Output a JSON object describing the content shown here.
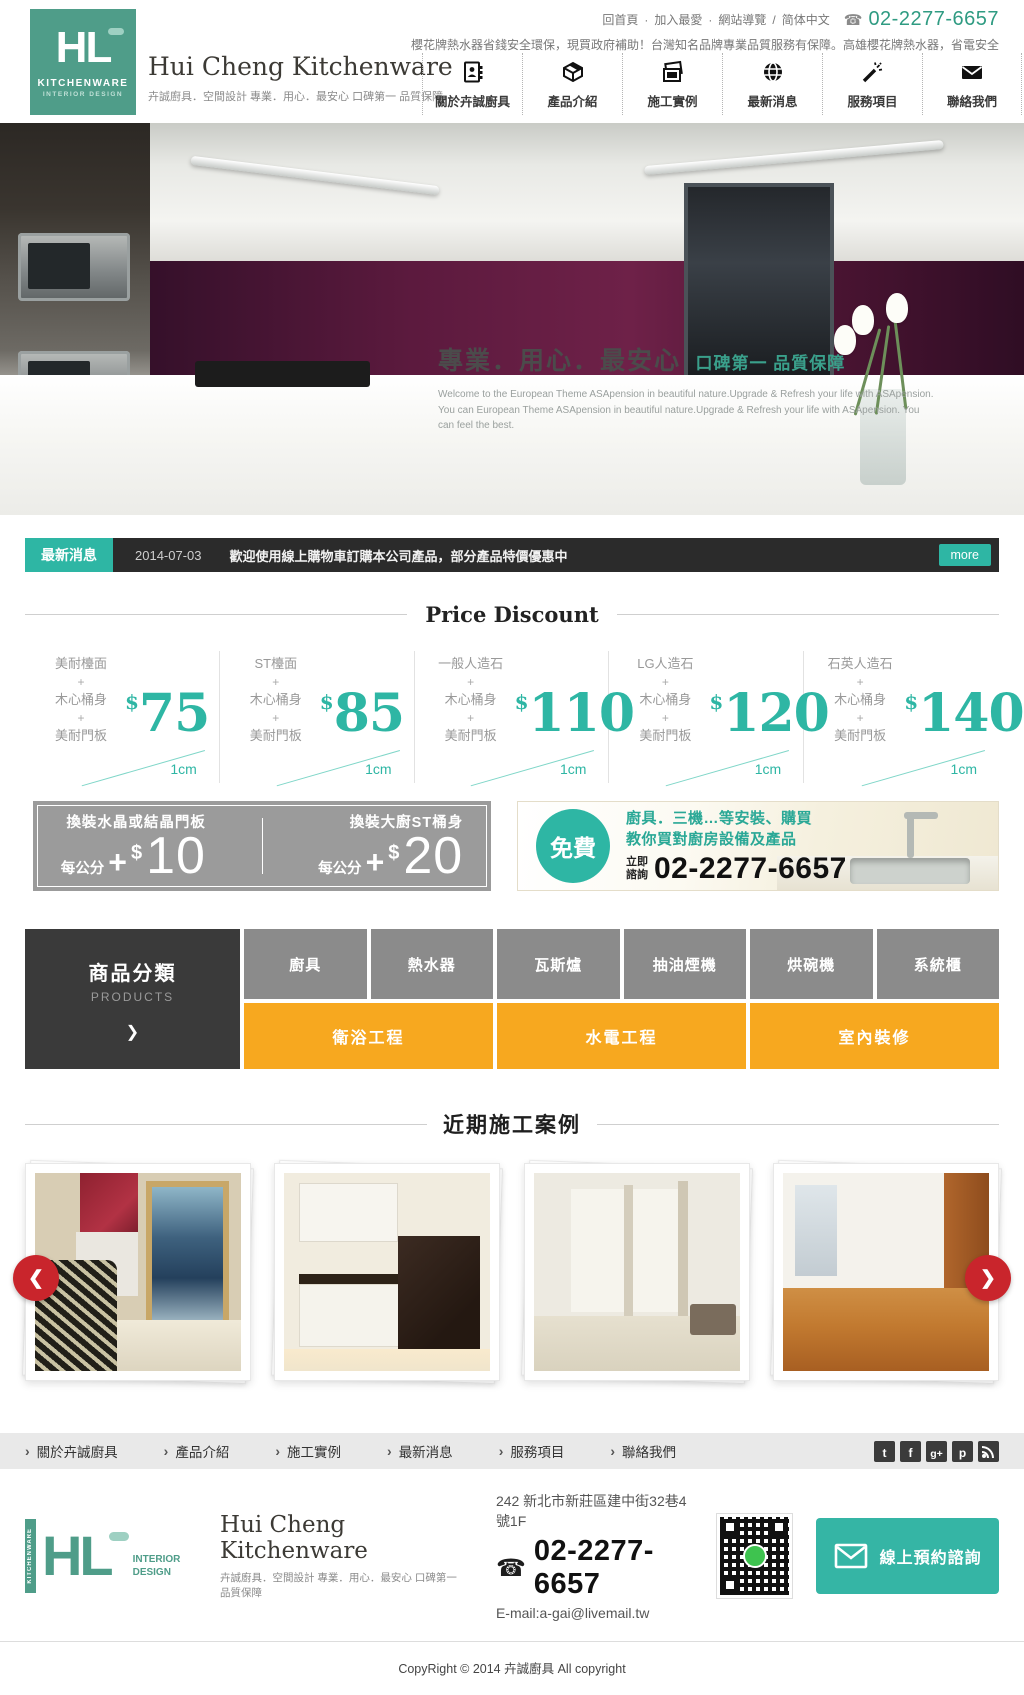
{
  "colors": {
    "brand_green": "#4f9d89",
    "accent_teal": "#2eb6a4",
    "orange": "#f7a81f",
    "dark_bar": "#2b2b2b",
    "gray_block": "#8b8b8b",
    "red_arrow": "#c9252c"
  },
  "topbar": {
    "links": [
      {
        "label": "回首頁"
      },
      {
        "label": "加入最愛"
      },
      {
        "label": "網站導覽"
      },
      {
        "label": "简体中文"
      }
    ],
    "sep": "·",
    "slash": "/",
    "phone_icon": "☎",
    "phone": "02-2277-6657",
    "marquee": "櫻花牌熱水器省錢安全環保，現買政府補助！台灣知名品牌專業品質服務有保障。高雄櫻花牌熱水器，省電安全"
  },
  "brand": {
    "monogram": "HL",
    "kitchenware": "KITCHENWARE",
    "interior": "INTERIOR DESIGN",
    "name": "Hui Cheng Kitchenware",
    "tagline": "卉誠廚具．空間設計 專業．用心．最安心 口碑第一 品質保障"
  },
  "nav": {
    "items": [
      {
        "label": "關於卉誠廚具",
        "icon": "address-book-icon"
      },
      {
        "label": "產品介紹",
        "icon": "product-box-icon"
      },
      {
        "label": "施工實例",
        "icon": "photos-icon"
      },
      {
        "label": "最新消息",
        "icon": "globe-icon"
      },
      {
        "label": "服務項目",
        "icon": "magic-wand-icon"
      },
      {
        "label": "聯絡我們",
        "icon": "envelope-icon"
      }
    ]
  },
  "hero": {
    "title": "專業．用心．最安心",
    "subtitle": "口碑第一 品質保障",
    "body": "Welcome to the European Theme ASApension in beautiful nature.Upgrade & Refresh your life with ASApension. You can European Theme ASApension in beautiful nature.Upgrade & Refresh your life with ASApension. You can feel the best."
  },
  "news": {
    "label": "最新消息",
    "date": "2014-07-03",
    "text": "歡迎使用線上購物車訂購本公司產品，部分產品特價優惠中",
    "more_label": "more"
  },
  "price": {
    "title": "Price Discount",
    "plus": "+",
    "currency": "$",
    "unit": "1cm",
    "cards": [
      {
        "top": "美耐檯面",
        "mid": "木心桶身",
        "bottom": "美耐門板",
        "value": "75"
      },
      {
        "top": "ST檯面",
        "mid": "木心桶身",
        "bottom": "美耐門板",
        "value": "85"
      },
      {
        "top": "一般人造石",
        "mid": "木心桶身",
        "bottom": "美耐門板",
        "value": "110"
      },
      {
        "top": "LG人造石",
        "mid": "木心桶身",
        "bottom": "美耐門板",
        "value": "120"
      },
      {
        "top": "石英人造石",
        "mid": "木心桶身",
        "bottom": "美耐門板",
        "value": "140"
      }
    ]
  },
  "addons": {
    "plus": "+",
    "currency": "$",
    "items": [
      {
        "label": "換裝水晶或結晶門板",
        "per": "每公分",
        "value": "10"
      },
      {
        "label": "換裝大廚ST桶身",
        "per": "每公分",
        "value": "20"
      }
    ]
  },
  "consult": {
    "badge": "免費",
    "line1": "廚具．三機…等安裝、購買",
    "line2": "教你買對廚房設備及產品",
    "cta1": "立即",
    "cta2": "諮詢",
    "phone": "02-2277-6657"
  },
  "products": {
    "title": "商品分類",
    "subtitle": "PRODUCTS",
    "arrow": "❯",
    "items": [
      "廚具",
      "熱水器",
      "瓦斯爐",
      "抽油煙機",
      "烘碗機",
      "系統櫃"
    ],
    "wide_items": [
      "衛浴工程",
      "水電工程",
      "室內裝修"
    ]
  },
  "cases": {
    "title": "近期施工案例",
    "prev": "❮",
    "next": "❯"
  },
  "footer_nav": {
    "arrow": "›",
    "items": [
      "關於卉誠廚具",
      "產品介紹",
      "施工實例",
      "最新消息",
      "服務項目",
      "聯絡我們"
    ],
    "social": [
      {
        "name": "twitter",
        "glyph": "t"
      },
      {
        "name": "facebook",
        "glyph": "f"
      },
      {
        "name": "google-plus",
        "glyph": "g+"
      },
      {
        "name": "plurk",
        "glyph": "p"
      },
      {
        "name": "rss",
        "glyph": ""
      }
    ]
  },
  "footer": {
    "address": "242 新北市新莊區建中街32巷4號1F",
    "phone_icon": "☎",
    "phone": "02-2277-6657",
    "email": "E-mail:a-gai@livemail.tw",
    "cta_label": "線上預約諮詢"
  },
  "copyright": "CopyRight © 2014 卉誠廚具 All copyright"
}
